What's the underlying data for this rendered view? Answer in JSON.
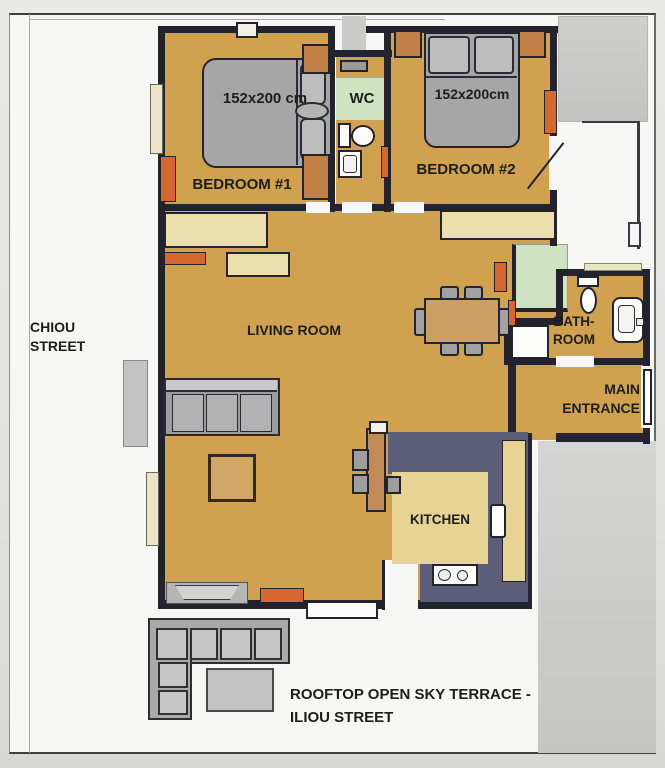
{
  "streets": {
    "left_line1": "CHIOU",
    "left_line2": "STREET"
  },
  "rooms": {
    "bedroom1": {
      "label": "BEDROOM #1",
      "bed_size": "152x200 cm"
    },
    "bedroom2": {
      "label": "BEDROOM #2",
      "bed_size": "152x200cm"
    },
    "wc": {
      "label": "WC"
    },
    "living": {
      "label": "LIVING ROOM"
    },
    "bathroom": {
      "label_line1": "BATH-",
      "label_line2": "ROOM"
    },
    "entrance": {
      "label_line1": "MAIN",
      "label_line2": "ENTRANCE"
    },
    "kitchen": {
      "label": "KITCHEN"
    }
  },
  "terrace": {
    "label_line1": "ROOFTOP OPEN SKY TERRACE -",
    "label_line2": "ILIOU STREET"
  },
  "colors": {
    "floor_tan": "#d0a24f",
    "wall_dark": "#23232e",
    "kitchen_slate": "#5b5e79",
    "counter_beige": "#e7d494",
    "wardrobe_beige": "#ecdfae",
    "accent_orange": "#d5672f",
    "closet_brown": "#c08046",
    "wet_green": "#cfe3c3",
    "furniture_gray": "#a6a6a6",
    "neighbor_gray": "#cbcbc9",
    "page_white": "#f6f6f4"
  }
}
